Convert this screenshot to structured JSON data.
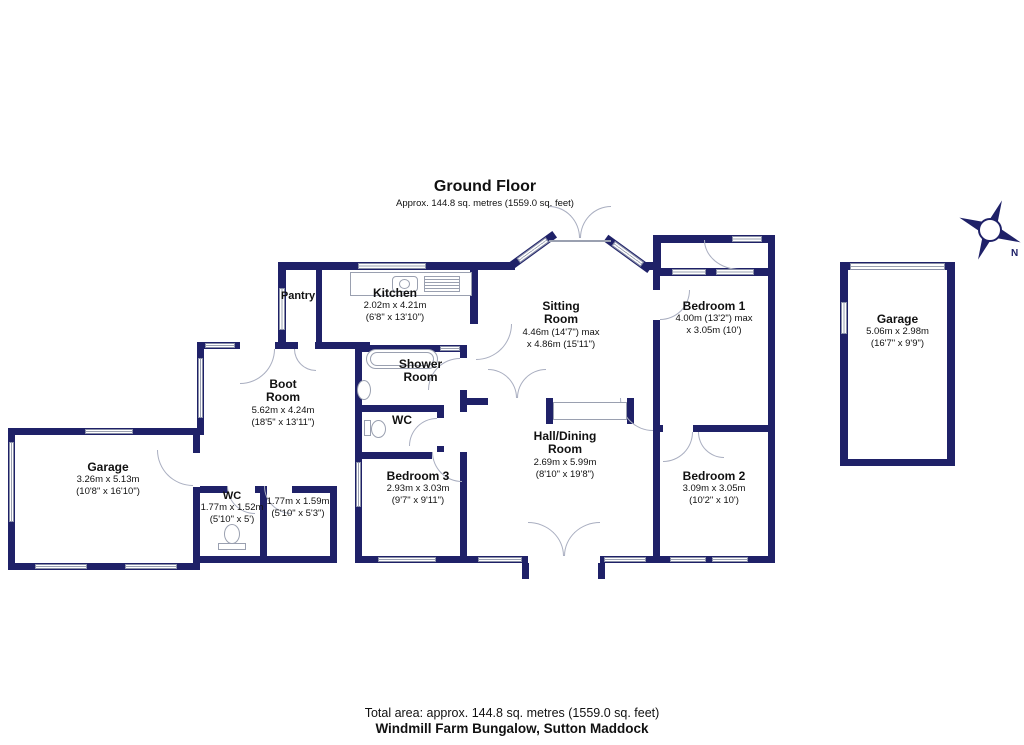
{
  "header": {
    "title": "Ground Floor",
    "subtitle": "Approx. 144.8 sq. metres (1559.0 sq. feet)"
  },
  "compass": {
    "north_label": "N"
  },
  "colors": {
    "wall": "#1f2168",
    "fixture_outline": "#9aa0b0",
    "text": "#111111"
  },
  "rooms": {
    "pantry": {
      "name": "Pantry"
    },
    "kitchen": {
      "name": "Kitchen",
      "metric": "2.02m x 4.21m",
      "imperial": "(6'8\" x 13'10\")"
    },
    "sitting_room": {
      "name1": "Sitting",
      "name2": "Room",
      "metric": "4.46m (14'7\") max",
      "imperial": "x 4.86m (15'11\")"
    },
    "bedroom1": {
      "name": "Bedroom 1",
      "metric": "4.00m (13'2\") max",
      "imperial": "x 3.05m (10')"
    },
    "garage_right": {
      "name": "Garage",
      "metric": "5.06m x 2.98m",
      "imperial": "(16'7\" x 9'9\")"
    },
    "boot_room": {
      "name1": "Boot",
      "name2": "Room",
      "metric": "5.62m x 4.24m",
      "imperial": "(18'5\" x 13'11\")"
    },
    "shower_room": {
      "name1": "Shower",
      "name2": "Room"
    },
    "wc_mid": {
      "name": "WC"
    },
    "hall": {
      "name1": "Hall/Dining",
      "name2": "Room",
      "metric": "2.69m x 5.99m",
      "imperial": "(8'10\" x 19'8\")"
    },
    "bedroom2": {
      "name": "Bedroom 2",
      "metric": "3.09m x 3.05m",
      "imperial": "(10'2\" x 10')"
    },
    "bedroom3": {
      "name": "Bedroom 3",
      "metric": "2.93m x 3.03m",
      "imperial": "(9'7\" x 9'11\")"
    },
    "garage_left": {
      "name": "Garage",
      "metric": "3.26m x 5.13m",
      "imperial": "(10'8\" x 16'10\")"
    },
    "wc_bottom": {
      "name": "WC",
      "metric": "1.77m x 1.52m",
      "imperial": "(5'10\" x 5')"
    },
    "store": {
      "metric": "1.77m x 1.59m",
      "imperial": "(5'10\" x 5'3\")"
    }
  },
  "footer": {
    "total_area": "Total area: approx. 144.8 sq. metres (1559.0 sq. feet)",
    "property_name": "Windmill Farm Bungalow, Sutton Maddock"
  }
}
